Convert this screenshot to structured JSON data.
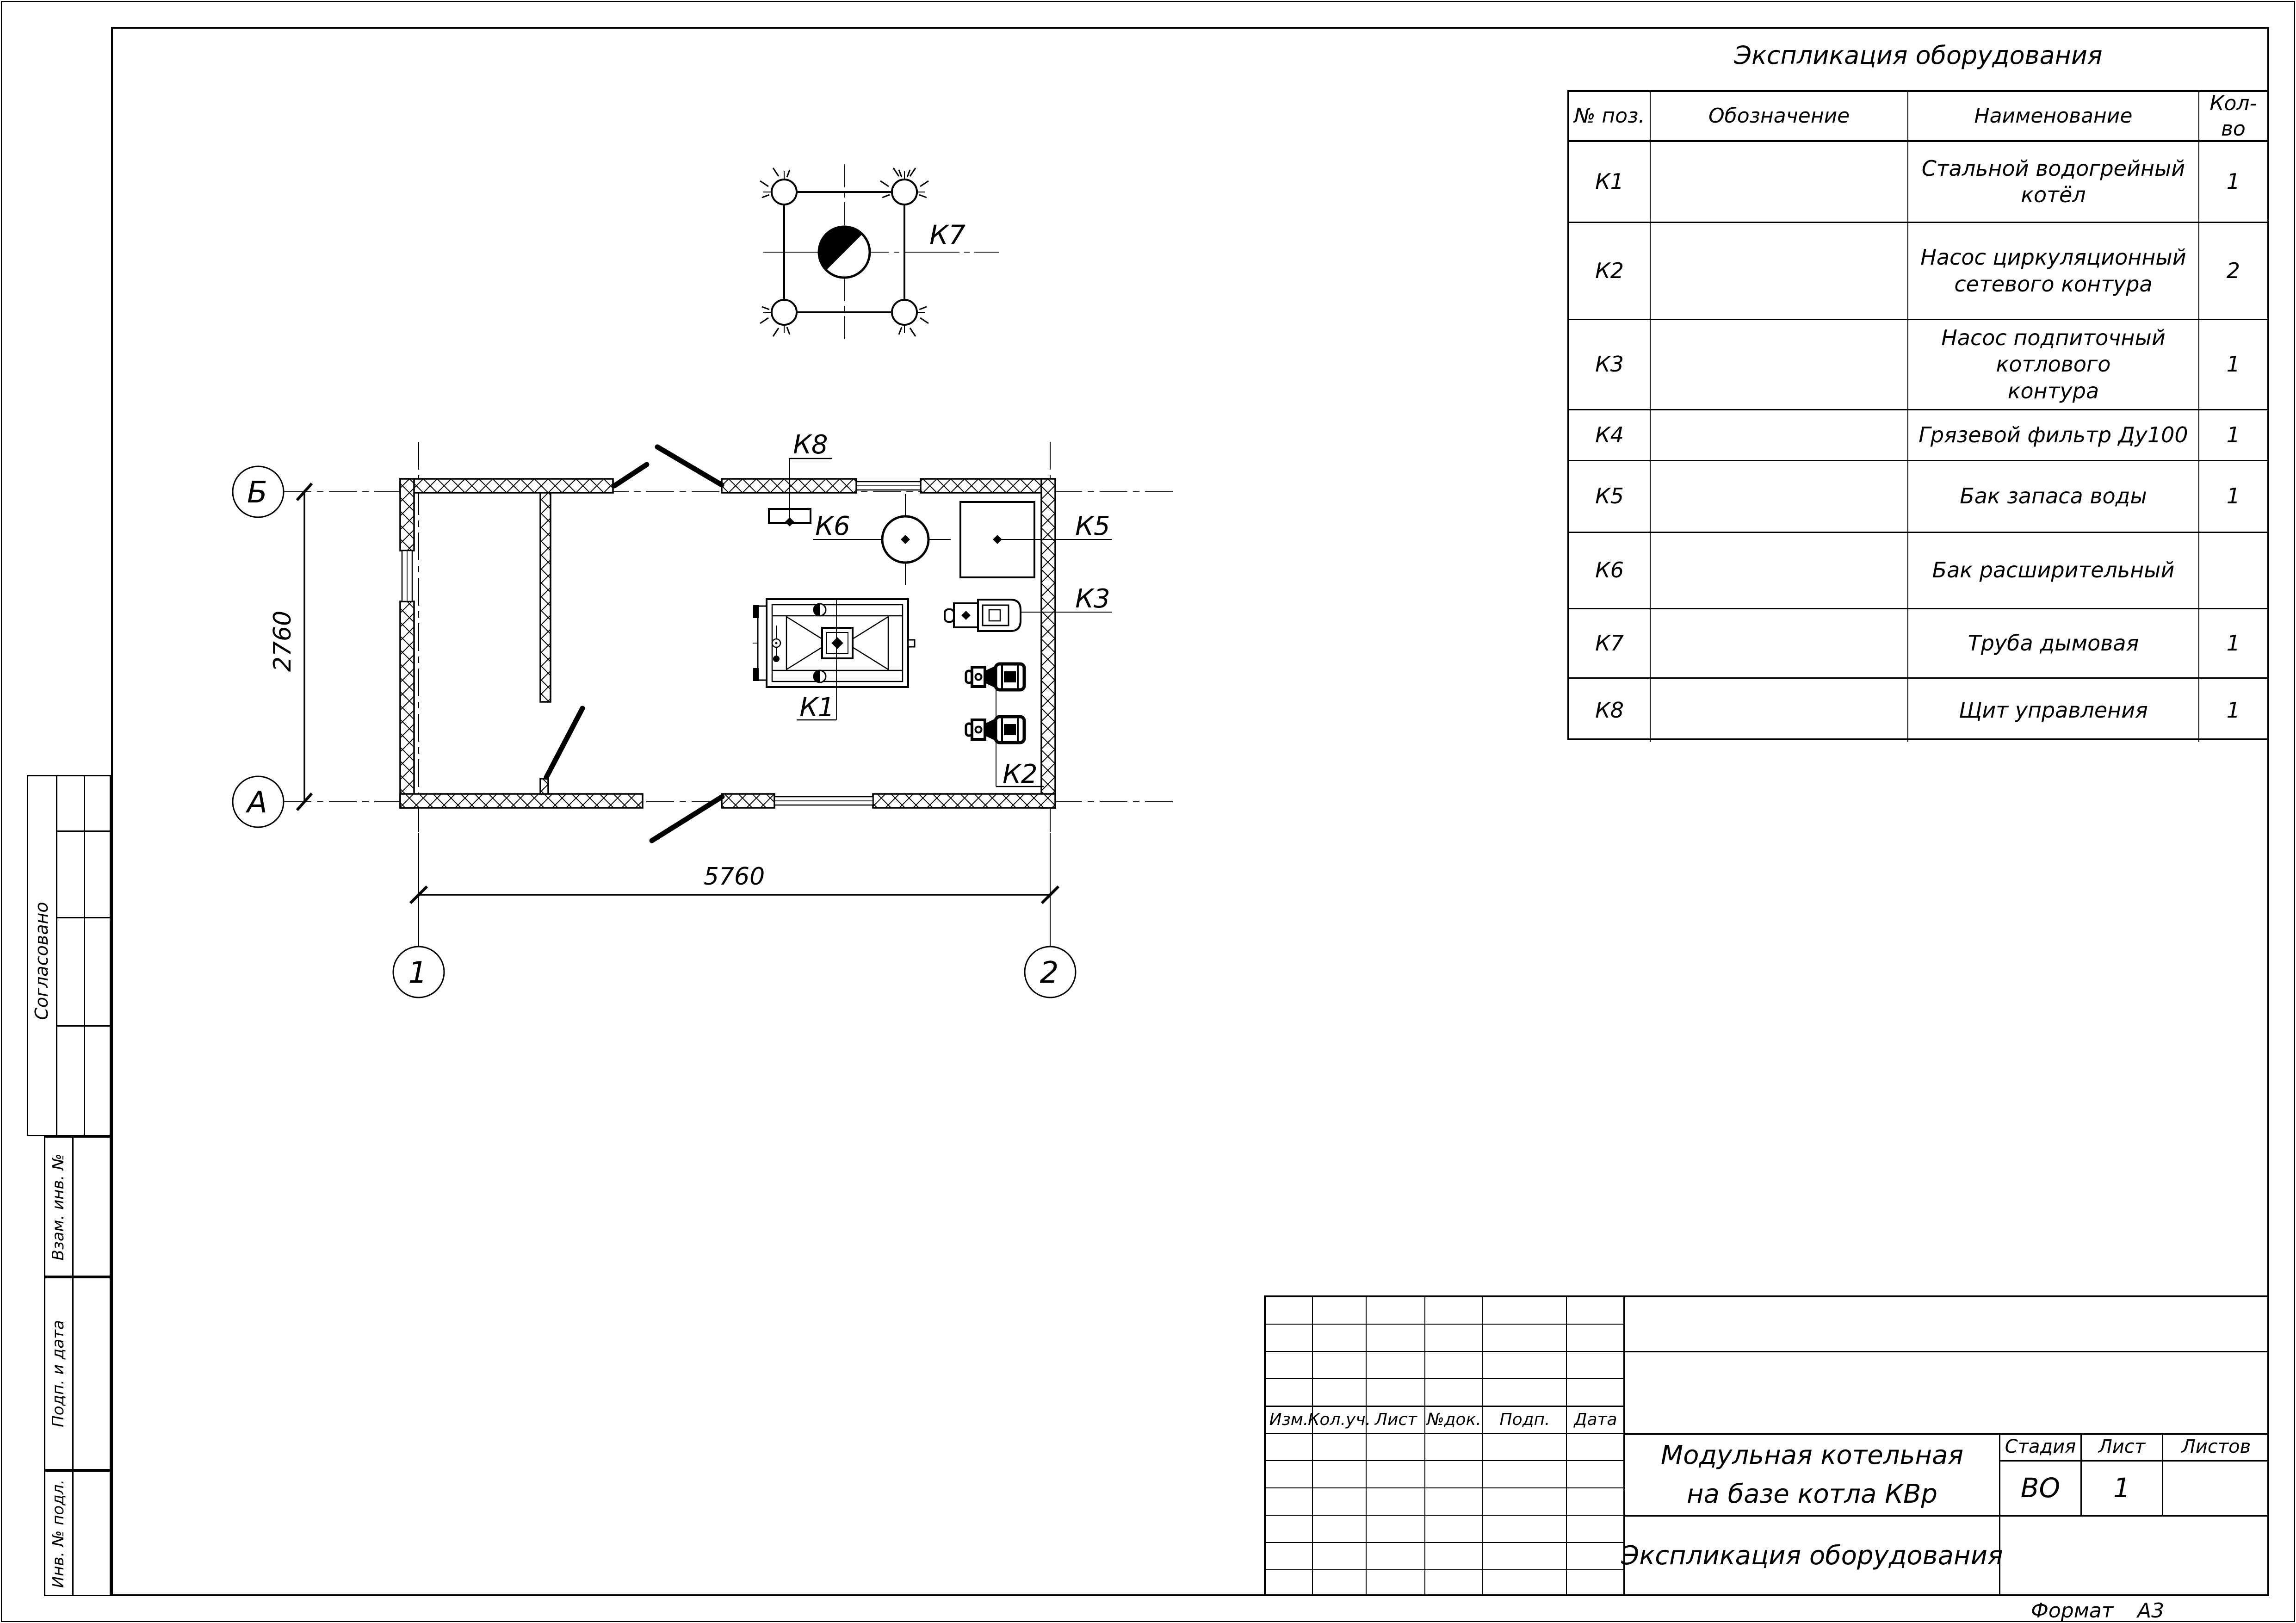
{
  "page": {
    "format_label": "Формат",
    "format_value": "А3"
  },
  "equipment_table": {
    "title": "Экспликация оборудования",
    "columns": [
      "№ поз.",
      "Обозначение",
      "Наименование",
      "Кол-во"
    ],
    "rows": [
      {
        "pos": "К1",
        "designation": "",
        "name": "Стальной водогрейный котёл",
        "qty": "1"
      },
      {
        "pos": "К2",
        "designation": "",
        "name": "Насос циркуляционный\nсетевого контура",
        "qty": "2"
      },
      {
        "pos": "К3",
        "designation": "",
        "name": "Насос подпиточный котлового\nконтура",
        "qty": "1"
      },
      {
        "pos": "К4",
        "designation": "",
        "name": "Грязевой фильтр Ду100",
        "qty": "1"
      },
      {
        "pos": "К5",
        "designation": "",
        "name": "Бак запаса воды",
        "qty": "1"
      },
      {
        "pos": "К6",
        "designation": "",
        "name": "Бак расширительный",
        "qty": ""
      },
      {
        "pos": "К7",
        "designation": "",
        "name": "Труба дымовая",
        "qty": "1"
      },
      {
        "pos": "К8",
        "designation": "",
        "name": "Щит управления",
        "qty": "1"
      }
    ]
  },
  "plan": {
    "labels": {
      "k1": "К1",
      "k2": "К2",
      "k3": "К3",
      "k5": "К5",
      "k6": "К6",
      "k7": "К7",
      "k8": "К8"
    },
    "axes": {
      "a": "А",
      "b": "Б",
      "n1": "1",
      "n2": "2"
    },
    "dimensions": {
      "width": "5760",
      "height": "2760"
    }
  },
  "title_block": {
    "header_cols": [
      "Изм.",
      "Кол.уч.",
      "Лист",
      "№док.",
      "Подп.",
      "Дата"
    ],
    "project": "Модульная котельная\nна базе котла КВр",
    "sheet_title": "Экспликация оборудования",
    "stage_label": "Стадия",
    "stage_value": "ВО",
    "sheet_label": "Лист",
    "sheet_value": "1",
    "sheets_label": "Листов",
    "sheets_value": ""
  },
  "side_stamps": {
    "agreed": "Согласовано",
    "replace_inv": "Взам. инв. №",
    "sign_date": "Подп. и дата",
    "inv_orig": "Инв. № подл."
  }
}
